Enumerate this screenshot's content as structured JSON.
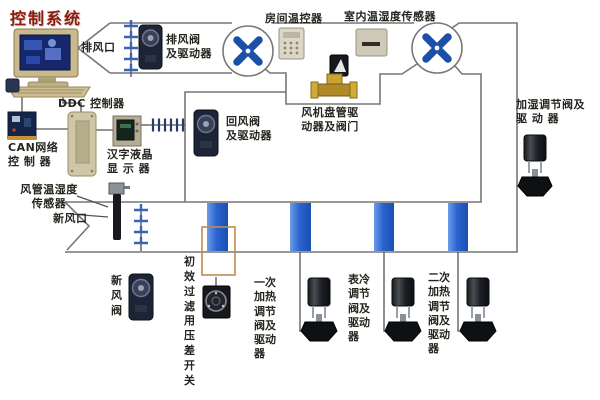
{
  "title": "控制系统",
  "colors": {
    "title_red": "#8f1a0a",
    "fan_blue": "#1b4fa8",
    "pipe_blue": "#2a64cf",
    "duct_gray": "#777777",
    "filter_orange": "#c08a50",
    "valve_brass": "#b08a28"
  },
  "labels": {
    "exhaust_outlet": "排风口",
    "exhaust_valve_line1": "排风阀",
    "exhaust_valve_line2": "及驱动器",
    "room_thermostat": "房间温控器",
    "indoor_temp_humidity_sensor": "室内温湿度传感器",
    "ddc_controller": "DDC 控制器",
    "can_controller_line1": "CAN网络",
    "can_controller_line2": "控 制 器",
    "lcd_display_line1": "汉字液晶",
    "lcd_display_line2": "显 示 器",
    "return_valve_line1": "回风阀",
    "return_valve_line2": "及驱动器",
    "fan_coil_line1": "风机盘管驱",
    "fan_coil_line2": "动器及阀门",
    "humidifier_valve_line1": "加湿调节阀及",
    "humidifier_valve_line2": "驱  动  器",
    "duct_sensor_line1": "风管温湿度",
    "duct_sensor_line2": "传感器",
    "fresh_air_outlet": "新风口",
    "fresh_air_valve": "新风阀",
    "filter_pressure_switch": "初效过滤用压差开关",
    "primary_heating_valve": "一次加热调节阀及驱动器",
    "cooling_coil_valve": "表冷调节阀及驱动器",
    "secondary_heating_valve": "二次加热调节阀及驱动器"
  }
}
